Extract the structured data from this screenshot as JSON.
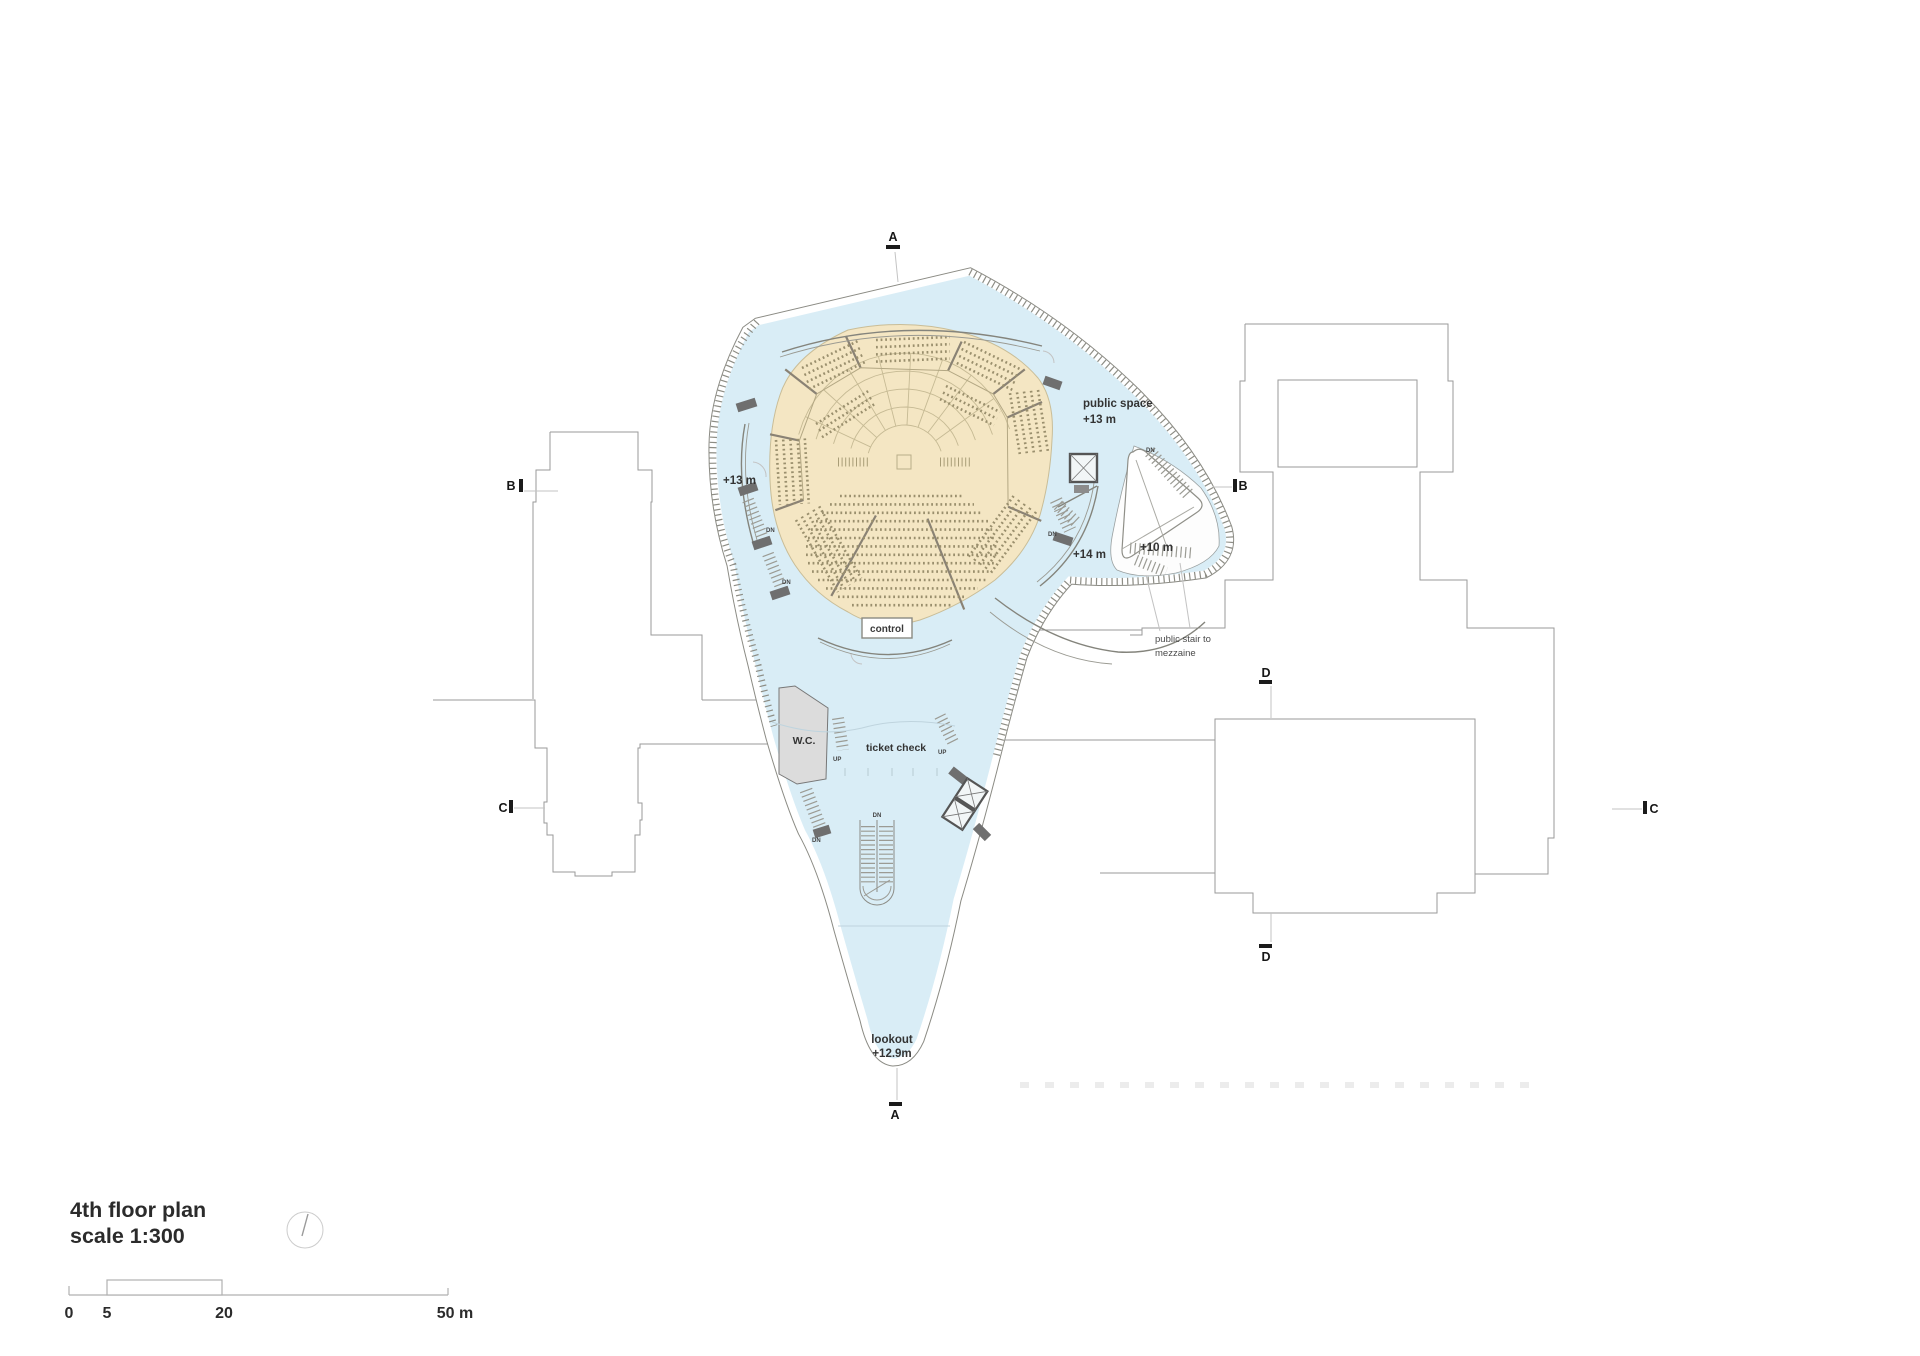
{
  "title_block": {
    "line1": "4th floor plan",
    "line2": "scale 1:300"
  },
  "scale_bar": {
    "n0": "0",
    "n5": "5",
    "n20": "20",
    "n50": "50 m"
  },
  "section_markers": {
    "a": "A",
    "b": "B",
    "c": "C",
    "d": "D"
  },
  "plan_labels": {
    "public_space_line1": "public space",
    "public_space_line2": "+13 m",
    "level_13": "+13 m",
    "level_14": "+14 m",
    "level_10": "+10 m",
    "stair_note_line1": "public stair to",
    "stair_note_line2": "mezzaine",
    "control": "control",
    "wc": "W.C.",
    "ticket_check": "ticket check",
    "lookout_line1": "lookout",
    "lookout_line2": "+12.9m"
  },
  "stair_dir": {
    "dn": "DN",
    "up": "UP"
  },
  "colors": {
    "floor_blue": "#d9edf6",
    "hall_beige": "#f4e6c3",
    "void_white": "#fdfdfd",
    "wall_gray": "#8a8a82",
    "seat_brown": "#9a8f6d"
  }
}
